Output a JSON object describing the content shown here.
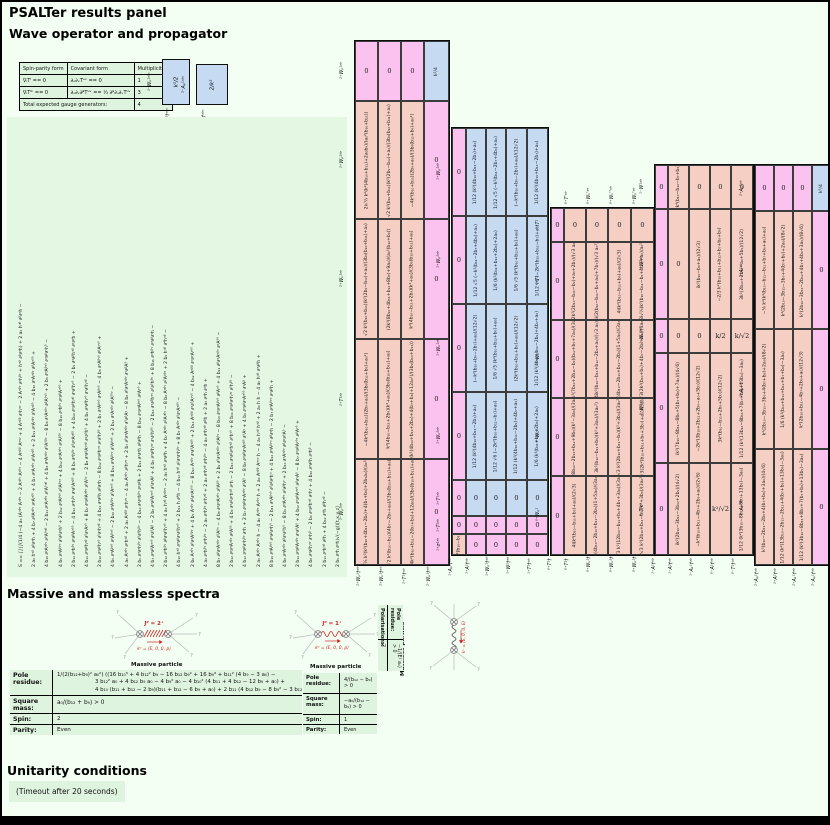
{
  "page": {
    "title": "PSALTer results panel"
  },
  "sections": {
    "wave": "Wave operator and propagator",
    "spectra": "Massive and massless spectra",
    "unitarity": "Unitarity conditions"
  },
  "gauge_table": {
    "headers": [
      "Spin-parity form",
      "Covariant form",
      "Multiplicities"
    ],
    "rows": [
      [
        "∇ᵢTⁱ == 0",
        "∂ᵤ∂ᵥTᵘᵛ == 0",
        "1"
      ],
      [
        "∇ᵢTⁱᵏ == 0",
        "∂ᵤ∂ᵥ∂ᵝTᵘᵛ == ⅓ ∂ᵝ∂ᵤ∂ᵥTᵘᵛ",
        "3"
      ]
    ],
    "footer": [
      "Total expected gauge generators:",
      "4"
    ]
  },
  "mini_blocks": [
    {
      "left_label": "²⁻Wₚ¹ᵃᵇᶜ",
      "bottom_label": "²⁻Wₚ¹†ᵃᵇᶜ",
      "value": "k²/2"
    },
    {
      "left_label": "²⁻Aₚ¹ᵃᵇᶜ",
      "bottom_label": "²⁻Aₚ¹†ᵃᵇᶜ",
      "value": "2/k²"
    }
  ],
  "action_columns": [
    "S == ∫∫∫∫(1/4 (−4 a₀ (Aᵅᵝᵞ Aᵅᵝᵞ − 2 Aᵅᵝᵞ Aᵞᵝᵅ − 4 Aᵅᵝᵝ Aᵅᵞᵞ + 4 Aᵅᵝᵝ ∂ᵞhᵅᵞ − 2 Aᵅᵝᵞ ∂ᵅhᵝᵞ + hᵅᵝ ∂ᵝ∂ᵅh) + 2 a₀ hᵅᵝ ∂ᵝ∂ᵅh −",
    "2 a₀ hᵅᵝ ∂ᵝ∂ᵅh + 4 b₇ ∂ᵝAᵅᵝᵞ ∂ᵞAᵅᵟᵟ + 4 b₇ ∂ᵞAᵅᵝᵞ ∂ᵟAᵅᵝᵟ + 2 b₁₁ ∂ᵞAᵅᵝᵞ ∂ᵟAᵅᵝᵟ − 4 b₁₀ ∂ᵞAᵅᵝᵞ ∂ᵝAᵅᵟᵟ +",
    "4 b₁₀ ∂ᵞAᵅᵝᵞ ∂ᵟAᵟᵅᵝ − 2 b₁₁ ∂ᵞAᵅᵝᵞ ∂ᵟAᵟᵅᵝ + 4 b₈ ∂ᵅAᵅᵝᵞ ∂ᵟAᵟᵝᵞ − 8 b₈ ∂ᵅAᵅᵝᵞ ∂ᵝAᵟᵞᵟ + 2 b₉ ∂ᵅAᵝᵞᵟ ∂ᵅ∂ᵝ∂ᵞhᵟ −",
    "4 b₉ ∂ᵅAᵝᵞᵅ ∂ᵟ∂ᵝ∂ᵞhᵟ + 2 b₁₂ ∂ᵅAᵝᵞᵟ ∂ᵟAᵝᵞᵅ + 4 b₁₂ ∂ᵅAᵅᵝᵞ ∂ᵞAᵝᵟᵟ − 8 b₁₀ ∂ᵅhᵝᵞ ∂ᵞ∂ᵝAᵅᵟᵟ +",
    "2 b₁₁ ∂ᵅhᵝᵞ ∂ᵞ∂ᵝAᵅᵟᵟ − 4 b₁₂ ∂ᵅhᵝᵞ ∂ᵞ∂ᵟAᵅᵝᵟ + 8 b₉ ∂ᵅhᵝᵞ ∂ᵟ∂ᵞAᵅᵝᵟ + 4 b₁₀ ∂ᵅ∂ᵝhᵅᵝ ∂ᵞ∂ᵟhᵞᵟ − 2 b₉ ∂ᵅ∂ᵝhᵅᵝ ∂ᵞ∂ᵞh +",
    "4 b₁₁ ∂ᵅ∂ᵝhᵅᵝ ∂ᵟ∂ᵞAᵞᵟ + 8 b₇ ∂ᵅ∂ᵝAᵅᵝᵞ ∂ᵟAᵟᵞ − 2 b₈ ∂ᵅ∂ᵝAᵞᵅᵝ ∂ᵞ∂ᵟhᵟ + 4 b₉ ∂ᵅ∂ᵝhᵞᵟ ∂ᵞ∂ᵟhᵅᵝ −",
    "2 b₁₀ ∂ᵅ∂ᵝhᵞᵟ ∂ᵟ∂ᵞhᵅᵝ + 4 b₁₁ ∂ᵅ∂ᵝh ∂ᵝ∂ᵅh − 8 b₁₂ ∂ᵅ∂ᵝhᵅᵞ ∂ᵞ∂ᵟhᵝᵟ + 2 b₇ ∂ᵅAᵝᵞᵟ ∂ᵅAᵝᵞᵟ − 4 b₈ ∂ᵅAᵝᵞᵟ ∂ᵝAᵅᵞᵟ +",
    "4 b₉ ∂ᵅAᵝᵞᵟ ∂ᵞAᵝᵅᵟ − 2 b₁₀ ∂ᵅAᵝᵝᵞ ∂ᵟAᵅᵞᵟ + 8 b₁₁ ∂ᵅAᵝᵞᵞ ∂ᵟAᵝᵅᵟ + 2 b₁₂ ∂ᵅAᵅᵝᵞ ∂ᵝAᵟᵟᵞ −",
    "4 a₀ Aᵅᵝᵞ ∂ᵞhᵅᵝ + 2 a₀ Aᵅᵝᵝ ∂ᵞhᵅᵞ − 4 a₀ Aᵅᵝᵞ ∂ᵝhᵅᵞ + 2 b₇ ∂ᵟ∂ᵅAᵅᵝᵞ ∂ᵟ∂ᵝAᵞ − 8 b₈ ∂ᵟ∂ᵅAᵅᵝᵞ ∂ᵞ∂ᵝAᵟ +",
    "2 b₉ ∂ᵅ∂ᵅhᵝᵞ ∂ᵟ∂ᵟhᵝᵞ − 4 b₁₀ ∂ᵅ∂ᵅhᵝᵞ ∂ᵞ∂ᵝh + 2 b₁₁ ∂ᵅ∂ᵅh ∂ᵝ∂ᵝh − 8 b₁₂ ∂ᵅ∂ᵅAᵝᵞᵟ ∂ᵝAᵞᵟ +",
    "4 b₇ ∂ᵅ∂ᵝAᵅᵞᵟ ∂ᵞ∂ᵟAᵝ − 2 b₈ ∂ᵅ∂ᵝAᵅᵞᵟ ∂ᵟ∂ᵞAᵝ + 4 b₉ ∂ᵅ∂ᵝhᵅᵞ ∂ᵞ∂ᵟhᵝᵟ − 2 b₁₀ ∂ᵅ∂ᵝhᵅᵞ ∂ᵟ∂ᵟhᵝᵞ + 8 b₁₁ ∂ᵅhᵝᵞ ∂ᵅ∂ᵝ∂ᵞh −",
    "2 b₁₂ ∂ᵅhᵝᵞ ∂ᵝ∂ᵞ∂ᵟhᵅᵟ + 4 a₀ hᵅᵝ Aᵅᵝᵞᵞ − 2 a₀ hᵅᵝ ∂ᵅ∂ᵝh + 4 b₇ Aᵅᵝᵞ ∂²Aᵅᵝᵞ − 8 b₈ Aᵅᵝᵞ ∂²Aᵞᵝᵅ + 2 b₉ hᵅᵝ ∂⁴hᵅᵝ −",
    "4 b₁₀ hᵅᵝ ∂ᵅ∂ᵝ∂ᵞ∂ᵟhᵞᵟ + 2 b₁₁ h ∂⁴h − 4 b₁₂ hᵅᵝ ∂²∂ᵅ∂ᵞhᵝᵞ + 8 b₇ Aᵅᵝᵞ ∂ᵟ∂ᵞAᵅᵝᵟ −",
    "2 b₈ Aᵅᵝᵞ ∂ᵟ∂ᵅAᵟᵝᵞ + 4 b₉ Aᵅᵝᵞ ∂ᵝ∂ᵅAᵞᵟᵟ − 8 b₁₀ Aᵅᵝᵞ ∂ᵞ∂ᵟAᵅᵝᵟ + 2 b₁₁ Aᵅᵝᵝ ∂ᵞ∂ᵟAᵅᵞᵟ − 4 b₁₂ Aᵅᵝᵝ ∂ᵅ∂ᵞAᵞᵟᵟ +",
    "4 a₀ ∂ᵅhᵝᵞ ∂ᵅhᵝᵞ − 2 a₀ ∂ᵅhᵝᵞ ∂ᵞhᵅᵝ + 2 a₀ ∂ᵅhᵅᵝ ∂ᵞhᵝᵞ − 4 a₀ ∂ᵅhᵅᵝ ∂ᵝh + 2 a₀ ∂ᵅh ∂ᵅh +",
    "8 b₇ ∂ᵝ∂ᵅAᵅᵝᵞ ∂ᵟAᵟᵞ − 4 b₈ ∂ᵞ∂ᵅAᵅᵝᵞ ∂ᵟAᵝᵟ + 2 b₉ ∂ᵟ∂ᵅAᵅᵝᵞ ∂ᵟAᵝᵞ − 8 b₁₀ ∂ᵅ∂ᵅAᵝᵞᵟ ∂ᵝAᵞᵟ + 4 b₁₁ ∂ᵝ∂ᵅAᵅᵝᵞ ∂ᵞAᵟᵟ −",
    "2 b₁₂ ∂ᵞ∂ᵅAᵅᵝᵞ ∂ᵝAᵟᵟ + 4 b₉ ∂ᵅ∂ᵝ∂ᵞhᵅᵝ ∂ᵞh − 2 b₁₀ ∂ᵅ∂ᵝ∂ᵞhᵅᵝ ∂ᵟhᵞᵟ + 8 b₁₁ ∂ᵅ∂ᵝ∂ᵞhᵅᵞ ∂ᵟhᵝᵟ −",
    "4 b₁₂ ∂ᵅ∂ᵝ∂ᵞhᵝᵞ ∂ᵅh + 2 b₇ ∂ᵅ∂ᵝ∂ᵞAᵅᵝᵞ ∂ᵟAᵟ − 8 b₈ ∂ᵅ∂ᵝ∂ᵞAᵅᵝᵟ ∂ᵟAᵞ + 4 b₉ ∂ᵅ∂ᵝ∂ᵞAᵅᵟᵟ ∂ᵞAᵝ +",
    "2 a₀ Aᵅᵝᵞ Aᵅᵝᵞ h − 4 a₀ Aᵅᵝᵞ Aᵞᵝᵅ h + 2 a₀ Aᵅᵝᵝ Aᵅᵞᵞ h − 4 a₀ hᵅᵝ hᵅᵝ + 2 a₀ h h − 4 a₀ hᵅᵝ ∂ᵅ∂ᵝh +",
    "8 b₁₀ ∂ᵅAᵝᵞᵟ ∂ᵅ∂ᵝ∂ᵞhᵟ − 2 b₁₁ ∂ᵅAᵝᵞᵟ ∂ᵟ∂ᵝ∂ᵞhᵅ + 4 b₁₂ ∂ᵅAᵝᵞᵅ ∂ᵝ∂ᵞh − 2 b₇ ∂ᵅAᵝᵞᵅ ∂ᵞ∂ᵝh +",
    "4 b₈ ∂ᵅAᵅᵝᵞ ∂ᵝ∂ᵞ∂ᵟhᵟ − 8 b₉ ∂ᵅAᵅᵝᵞ ∂²∂ᵝhᵞ + 2 b₁₀ ∂ᵅAᵅᵝᵞ ∂ᵝ∂ᵞ∂ᵟAᵟ −",
    "2 b₁₁ ∂ᵅ∂ᵝAᵅᵝᵞ ∂ᵞ∂ᵟAᵟ + 4 b₁₂ ∂ᵅ∂ᵝAᵅᵞᵟ ∂ᵝ∂ᵞAᵟ − 8 b₇ ∂ᵅ∂ᵝAᵞᵟᵅ ∂ᵝAᵞᵟ +",
    "4 b₈ ∂ᵅ∂ᵝhᵅᵞ ∂ᵞhᵝ − 2 b₉ ∂ᵅ∂ᵝhᵅᵝ ∂ᵞhᵞ + 4 b₁₀ ∂ᵅ∂ᵝh ∂ᵅhᵝ −",
    "2 b₁₁ ∂ᵅhᵅᵝ ∂ᵝh + 4 b₁₂ ∂ᵅh ∂ᵝhᵅᵝ −",
    "2 b₉ ∂ᵅh ∂ᵅh)√(−g))[t,x,y,z]"
  ],
  "matrices": [
    {
      "id": "b",
      "sector": "2⁺ / 2⁻",
      "left_labels": [
        "²⁺Wₚ¹ᵃᵇ",
        "²⁺Wₚ²ᵃᵇ",
        "²⁺Wₖ¹ᵃᵇ",
        "²⁺T¹ᵃᵇ",
        "²⁻Wₚ¹ᵃᵇ"
      ],
      "bottom_labels": [
        "²⁺Wₚ¹†ᵃᵇ",
        "²⁺Wₖ¹†ᵃᵇ",
        "²⁺T¹†ᵃᵇ",
        "²⁻Wₚ¹†ᵃᵇ"
      ],
      "rows": [
        [
          {
            "v": "0",
            "c": "p"
          },
          {
            "v": "0",
            "c": "p"
          },
          {
            "v": "0",
            "c": "p"
          },
          {
            "v": "k²/4",
            "c": "bl",
            "r": 1
          }
        ],
        [
          {
            "v": "2i√⅔ k²(k²(4b₁₀+b₁₁)+2a₀b₉)/(a₀²(b₁₀+b₁₁))",
            "c": "s",
            "r": 1
          },
          {
            "v": "√2 k²(b₁₀+b₁₁)(k²(2b₉−b₁₂)+a₀)/(3b₉(b₁₀+b₁₁)+a₀)",
            "c": "s",
            "r": 1
          },
          {
            "v": "−4k²(b₁₀+b₁₁)(2b₉+a₀)/(3b₉(b₁₂+b₉)+a₀²)",
            "c": "s",
            "r": 1
          },
          {
            "v": "0",
            "c": "p"
          }
        ],
        [
          {
            "v": "√2 k²(b₁₀+b₁₁)(k²(2b₉−b₁₂)+a₀)/(3b₉(b₁₀+b₁₁)+a₀)",
            "c": "s",
            "r": 1
          },
          {
            "v": "(2k²(8b₁₀+4b₁₁+b₁₂+8b₉)+9a₀)/(a₀²(b₁₀+b₉))",
            "c": "s",
            "r": 1
          },
          {
            "v": "k²(4b₁₀−b₁₁+2b₉)(k²+a₀)/(3b₉(b₁₀+b₁₁)+a₀)",
            "c": "s",
            "r": 1
          },
          {
            "v": "0",
            "c": "p"
          }
        ],
        [
          {
            "v": "−4k²(b₁₀+b₁₁)(2b₉+a₀)/(3b₉(b₁₂+b₉)+a₀²)",
            "c": "s",
            "r": 1
          },
          {
            "v": "k²(4b₁₀−b₁₁+2b₉)(k²+a₀)/(3b₉(b₁₀+b₁₁)+a₀)",
            "c": "s",
            "r": 1
          },
          {
            "v": "(k²(4b₁₀+b₁₁+2b₉)+4(b₇+b₈)+12a₀²)/(3b₉(b₁₀+b₁₁))",
            "c": "s",
            "r": 1
          },
          {
            "v": "0",
            "c": "p"
          }
        ],
        [
          {
            "v": "2i√⅙ k²(k²(b₁₀+4b₁₁−2b₉)+4(b₇+b₈)+2b₉a₀)/(a₀²b₉)",
            "c": "s",
            "r": 1
          },
          {
            "v": "√2 k²(b₁₀−b₁₁)(4b₇−2b₉+a₀)/(3b₉(b₁₀+b₁₁)+a₀)",
            "c": "s",
            "r": 1
          },
          {
            "v": "−4k²(b₁₀+b₁₁−2(b₇+b₈)+12a₀)/(3b₉(b₁₀+b₁₁)+a₀)",
            "c": "s",
            "r": 1
          },
          {
            "v": "0",
            "c": "p"
          }
        ]
      ]
    },
    {
      "id": "c",
      "sector": "1⁺",
      "left_labels": [
        "¹⁺Wₚ¹ᵃᵇ",
        "¹⁺Wₚ²ᵃᵇ",
        "¹⁺Wₖ¹ᵃᵇ",
        "¹⁺Wₖ²ᵃᵇ",
        "¹⁺T¹ᵃᵇ",
        "¹⁺T²ᵃᵇ",
        "¹⁺σ¹ᵃᵇ"
      ],
      "bottom_labels": [
        "¹⁺Aₚ¹†ᵃᵇ",
        "¹⁺A¹†ᵃᵇ",
        "¹⁺Wₚ¹†ᵃᵇ",
        "¹⁺W¹†ᵃᵇ",
        "¹⁺T¹†ᵃᵇ"
      ],
      "rows": [
        [
          {
            "v": "0",
            "c": "p"
          },
          {
            "v": "1/12 (k²(4b₁₀+b₁₁−2b₇)+a₀)",
            "c": "bl",
            "r": 1
          },
          {
            "v": "1/12 √5 (−k²(b₁₁−2b₇+4b₉)+a₀)",
            "c": "bl",
            "r": 1
          },
          {
            "v": "(−k²(b₁₀+b₉−2b₇)+a₀)/(12√2)",
            "c": "bl",
            "r": 1
          },
          {
            "v": "1/12 (k²(4b₁₀+b₁₁−2b₇)+a₀)",
            "c": "bl",
            "r": 1
          }
        ],
        [
          {
            "v": "0",
            "c": "p"
          },
          {
            "v": "1/12 √5 (−k²(b₁₁−2b₇+4b₉)+a₀)",
            "c": "bl",
            "r": 1
          },
          {
            "v": "1/6 (k²(b₁₁+b₁₂+2b₉)+2a₀)",
            "c": "bl",
            "r": 1
          },
          {
            "v": "1/6 √5 (k²(b₁₀+b₁₂+b₉)+a₀)",
            "c": "bl",
            "r": 1
          },
          {
            "v": "1/12 √6 (−2k²(b₁₀+b₁₂−b₇)+a₀)",
            "c": "bl",
            "r": 1
          }
        ],
        [
          {
            "v": "0",
            "c": "p"
          },
          {
            "v": "(−k²(b₁₀+b₉−2b₇)+a₀)/(12√2)",
            "c": "bl",
            "r": 1
          },
          {
            "v": "1/6 √5 (k²(b₁₀+b₁₂+b₉)+a₀)",
            "c": "bl",
            "r": 1
          },
          {
            "v": "(2k²(b₁₀+b₁₁+b₉)+a₀)/(12√2)",
            "c": "bl",
            "r": 1
          },
          {
            "v": "1/12 (k²(4b₁₀+b₁₁−2b₉)+4b₇+a₀)",
            "c": "bl",
            "r": 1
          }
        ],
        [
          {
            "v": "0",
            "c": "p"
          },
          {
            "v": "1/12 (k²(4b₁₀+b₁₁−2b₇)+a₀)",
            "c": "bl",
            "r": 1
          },
          {
            "v": "1/12 √6 (−2k²(b₁₀+b₁₂−b₇)+a₀)",
            "c": "bl",
            "r": 1
          },
          {
            "v": "1/12 (k²(4b₁₀+b₁₁−2b₉)+4b₇+a₀)",
            "c": "bl",
            "r": 1
          },
          {
            "v": "1/6 (k²(b₁₁+b₁₂+2b₉)+2a₀)",
            "c": "bl",
            "r": 1
          }
        ],
        [
          {
            "v": "0",
            "c": "p"
          },
          {
            "v": "0",
            "c": "bl"
          },
          {
            "v": "0",
            "c": "bl"
          },
          {
            "v": "0",
            "c": "bl"
          },
          {
            "v": "0",
            "c": "bl"
          }
        ],
        [
          {
            "v": "0",
            "c": "p"
          },
          {
            "v": "0",
            "c": "p"
          },
          {
            "v": "0",
            "c": "p"
          },
          {
            "v": "0",
            "c": "p"
          },
          {
            "v": "0",
            "c": "p"
          }
        ],
        [
          {
            "v": "1/4 (k²(b₁₀−b₁₁)+a₀)",
            "c": "s",
            "r": 1
          },
          {
            "v": "0",
            "c": "p"
          },
          {
            "v": "0",
            "c": "p"
          },
          {
            "v": "0",
            "c": "p"
          },
          {
            "v": "0",
            "c": "p"
          }
        ]
      ]
    },
    {
      "id": "d",
      "sector": "0⁺",
      "top_labels": [
        "⁰⁺T'ᵃᵇ",
        "⁰⁺Wₖ'ᵃᵇ",
        "⁰⁺Wₖ''ᵃᵇ",
        "⁰⁺Wₚ'ᵃᵇ"
      ],
      "left_labels": [
        "⁰⁺T¹",
        "⁰⁺T²",
        "⁰⁺Wₖ¹",
        "⁰⁺Wₖ²",
        "⁰⁺Wₚ¹"
      ],
      "bottom_labels": [
        "⁰⁺T¹†",
        "⁰⁺T²†",
        "⁰⁺Wₖ¹†",
        "⁰⁺Wₖ²†",
        "⁰⁺Wₚ¹†"
      ],
      "rows": [
        [
          {
            "v": "0",
            "c": "p"
          },
          {
            "v": "0",
            "c": "s"
          },
          {
            "v": "0",
            "c": "s"
          },
          {
            "v": "0",
            "c": "s"
          },
          {
            "v": "0",
            "c": "s"
          }
        ],
        [
          {
            "v": "0",
            "c": "p"
          },
          {
            "v": "4(2k²(2b₁₀−b₁₁−b₉)+a₀+2b₇)/(√3 a₀²)",
            "c": "s",
            "r": 1
          },
          {
            "v": "4i(2(b₁₀−b₁₁−b₉+a₀)+7b₇)/(√3 a₀²)",
            "c": "s",
            "r": 1
          },
          {
            "v": "4i(k²(b₁₀−b₁₁+b₉)+a₀)/(2√3)",
            "c": "s",
            "r": 1
          },
          {
            "v": "8i√⅔(k²(b₁₀−b₁₁−b₉+4b₇)+a₀)/a₀²",
            "c": "s",
            "r": 1
          }
        ],
        [
          {
            "v": "0",
            "c": "p"
          },
          {
            "v": "−2k²(7b₁₀+2b₁₁−b₉)(b₁₂+b₉+7a₀)/(3a₀²)",
            "c": "s",
            "r": 1
          },
          {
            "v": "4ik²(b₁₀−b₁₁+b₁₂−2b₉+a₀)/(√3 a₀)",
            "c": "s",
            "r": 1
          },
          {
            "v": "k²(4b₁₀−2b₁₁+b₁₂−2b₉)(1+5a₀)/(3a₀²)",
            "c": "s",
            "r": 1
          },
          {
            "v": "2√3(2k²(b₁₀+b₉)+4b₇−2b₉+a₀)/(3a₀²)",
            "c": "s",
            "r": 1
          }
        ],
        [
          {
            "v": "0",
            "c": "p"
          },
          {
            "v": "k²(8b₁₀−2b₁₁+b₁₂+9b₉)(k²−3a₀)/(3a₀²)",
            "c": "s",
            "r": 1
          },
          {
            "v": "3k²(b₁₀−b₁₁+b₉)(k²+3a₀)/(3a₀²)",
            "c": "s",
            "r": 1
          },
          {
            "v": "2√3 k²(2b₁₀+b₁₁−b₉)(k²+3b₉)/(3a₀²)",
            "c": "s",
            "r": 1
          },
          {
            "v": "3√3(2k²(b₁₀+b₁₁+b₉+3b₇)+a₀)/(3a₀²)",
            "c": "s",
            "r": 1
          }
        ],
        [
          {
            "v": "0",
            "c": "p"
          },
          {
            "v": "4i(k²(b₁₀−b₁₁+b₉)+a₀)/(2√3)",
            "c": "s",
            "r": 1
          },
          {
            "v": "k²(4b₁₀−2b₁₁+b₁₂−2b₉)(1+5a₀)/(3a₀²)",
            "c": "s",
            "r": 1
          },
          {
            "v": "2√3 k²(12b₁₀−b₁₁+b₉+4b₇+3a₀)/(3a₀²)",
            "c": "s",
            "r": 1
          },
          {
            "v": "2√3 k²(2b₁₀+b₁₁−b₉)(k²+3b₉)/(3a₀²)",
            "c": "s",
            "r": 1
          }
        ]
      ]
    },
    {
      "id": "e",
      "sector": "1⁻ / 0⁻",
      "left_labels": [
        "¹⁻W¹ᵃᵇ",
        "¹⁻W²ᵃᵇ",
        "¹⁻Wₖ¹ᵃᵇ",
        "⁰⁻W¹ᵃᵇ",
        "⁰⁻T¹ᵃᵇ"
      ],
      "bottom_labels": [
        "¹⁻A¹†ᵃᵇ",
        "¹⁻A²†ᵃᵇ",
        "¹⁻Aₖ¹†ᵃᵇ",
        "⁰⁻A¹†ᵃᵇ",
        "⁰⁻T¹†ᵃᵇ"
      ],
      "rows": [
        [
          {
            "v": "0",
            "c": "p"
          },
          {
            "v": "1/4 (−2k⁴(b₁₀−b₁₁−b₇+b₈)+k²a₀)",
            "c": "s",
            "r": 1
          },
          {
            "v": "0",
            "c": "s"
          },
          {
            "v": "0",
            "c": "s"
          },
          {
            "v": "0",
            "c": "s"
          }
        ],
        [
          {
            "v": "0",
            "c": "p"
          },
          {
            "v": "0",
            "c": "s"
          },
          {
            "v": "ik²(b₁₀−b₉+a₀)/(2√3)",
            "c": "s",
            "r": 1
          },
          {
            "v": "−2/3 k²(b₁₀+b₁₁+b₁₂+b₇+b₈+b₉)",
            "c": "s",
            "r": 1
          },
          {
            "v": "3k²(2b₁₀+2b₁₂−a₀+5b₉)/(12√2)",
            "c": "s",
            "r": 1
          }
        ],
        [
          {
            "v": "0",
            "c": "p"
          },
          {
            "v": "0",
            "c": "s"
          },
          {
            "v": "0",
            "c": "s"
          },
          {
            "v": "k/2",
            "c": "s"
          },
          {
            "v": "k/√2",
            "c": "s"
          }
        ],
        [
          {
            "v": "0",
            "c": "p"
          },
          {
            "v": "ik²(7b₁₀−8b₁₁−8b₉+5(b₇+b₈)+7a₀)/(4√6)",
            "c": "s",
            "r": 1
          },
          {
            "v": "−2k²(3b₁₀+2b₁₁+2b₉−a₀+5b₇)/(12√2)",
            "c": "s",
            "r": 1
          },
          {
            "v": "3k²(b₁₀−b₁₁+2b₉+5b₇)/(12√2)",
            "c": "s",
            "r": 1
          },
          {
            "v": "1/12 (k²(13b₁₀−8b₁₁+7(b₇+b₈)+13b₉)−3a₀)",
            "c": "s",
            "r": 1
          }
        ],
        [
          {
            "v": "0",
            "c": "p"
          },
          {
            "v": "ik²(2b₁₀−3b₁₁−3b₁₂+2b₉)/(4√2)",
            "c": "s",
            "r": 1
          },
          {
            "v": "−k²(b₁₀+b₁₁−4b₇+2b₉+a₀)/(2√6)",
            "c": "s",
            "r": 1
          },
          {
            "v": "k²/√2",
            "c": "s"
          },
          {
            "v": "1/12 (k²(3b₁₀−8b₁₁+8b₇+13b₉)−3a₀)",
            "c": "s",
            "r": 1
          }
        ]
      ]
    },
    {
      "id": "f",
      "sector": "2⁺ A / 2⁻ A",
      "left_labels": [
        "²⁺Aₚ¹ᵃᵇ",
        "²⁺A¹ᵃᵇ",
        "²⁺Aₖ¹ᵃᵇ",
        "²⁻Aₚ¹ᵃᵇ"
      ],
      "bottom_labels": [
        "²⁺Aₚ¹†ᵃᵇ",
        "²⁺A¹†ᵃᵇ",
        "²⁺Aₖ¹†ᵃᵇ",
        "²⁻Aₚ¹†ᵃᵇ"
      ],
      "rows": [
        [
          {
            "v": "0",
            "c": "p"
          },
          {
            "v": "0",
            "c": "p"
          },
          {
            "v": "0",
            "c": "p"
          },
          {
            "v": "k²/4",
            "c": "bl",
            "r": 1
          }
        ],
        [
          {
            "v": "−⅛ k²(k²(b₁₀−b₁₁−b₁₂+b₇+b₈+a₀)+a₀)",
            "c": "s",
            "r": 1
          },
          {
            "v": "k²(2b₁₀−3b₁₁−3b₉+4(b₇+b₈)+2a₀)/(8√2)",
            "c": "s",
            "r": 1
          },
          {
            "v": "k²(2b₁₀−3b₁₁−2b₁₂+4b₇+4b₉+3a₀)/(8√6)",
            "c": "s",
            "r": 1
          },
          {
            "v": "0",
            "c": "p"
          }
        ],
        [
          {
            "v": "k²(2b₁₀−3b₁₁−3b₉+4(b₇+b₈)+2a₀)/(8√2)",
            "c": "s",
            "r": 1
          },
          {
            "v": "1/6 (k²(b₁₀+b₁₁+b₁₂+b₇+b₈)−3a₀)",
            "c": "s",
            "r": 1
          },
          {
            "v": "k²(2b₁₀+b₁₁−4b₇+2b₉+a₀)/(12√3)",
            "c": "s",
            "r": 1
          },
          {
            "v": "0",
            "c": "p"
          }
        ],
        [
          {
            "v": "k²(b₁₀−2b₁₁−2b₉+4(b₇+b₈)+3a₀)/(4√6)",
            "c": "s",
            "r": 1
          },
          {
            "v": "1/12 (k²(13b₁₀−2b₁₁−2b₁₂+4(b₇+b₈)+13b₉)−3a₀)",
            "c": "s",
            "r": 1
          },
          {
            "v": "1/12 (k²(3b₁₀−8b₁₁+8b₇+7(b₇+b₈)+13b₉)−3a₀)",
            "c": "s",
            "r": 1
          },
          {
            "v": "0",
            "c": "p"
          }
        ]
      ]
    }
  ],
  "diagrams": {
    "massive1": {
      "jp": "Jᴾ = 2⁺",
      "k": "kᵘ = (E, 0, 0, p)",
      "caption": "Massive particle"
    },
    "massive2": {
      "jp": "Jᴾ = 1⁺",
      "k": "kᵘ = (E, 0, 0, p)",
      "caption": "Massive particle"
    },
    "massless": {
      "k": "kᵘ = (E, 0, 0, E)",
      "caption": "Massless particle"
    }
  },
  "spectra": {
    "massive1": {
      "pole_label": "Pole residue:",
      "pole_lines": [
        "1/(2(b₁₂+b₉)² a₀²) ((16 b₁₀³ + 4 b₁₂² b₉ − 16 b₁₂ b₉² + 16 b₉³ + b₁₁² (4 b₉ − 3 a₀) −",
        "3 b₁₂² a₀ + 4 b₁₂ b₉ a₀ − 4 b₉² a₀ − 4 b₁₀² (4 b₁₁ + 4 b₁₂ − 12 b₉ + a₀) +",
        "4 b₁₀ (b₁₁ + b₁₂ − 2 b₉)(b₁₁ + b₁₂ − 6 b₉ + a₀) + 2 b₁₁ (4 b₁₂ b₉ − 8 b₉² − 3 b₁₂ a₀ + 2 b₉ a₀)) > 0"
      ],
      "square_label": "Square mass:",
      "square": "a₀/(b₁₂ + b₉) > 0",
      "spin_label": "Spin:",
      "spin": "2",
      "parity_label": "Parity:",
      "parity": "Even"
    },
    "massive2": {
      "pole_label": "Pole residue:",
      "pole": "4/(b₁₂ − b₉) > 0",
      "square_label": "Square mass:",
      "square": "−a₀/(b₁₂ − b₉) > 0",
      "spin_label": "Spin:",
      "spin": "1",
      "parity_label": "Parity:",
      "parity": "Even"
    },
    "massless": {
      "pole_label": "Pole residue:",
      "pole": "−1/(E² a₀) > 0",
      "polarisations_label": "Polarisations:",
      "polarisations": "2"
    }
  },
  "unitarity": {
    "timeout": "(Timeout after 20 seconds)"
  }
}
